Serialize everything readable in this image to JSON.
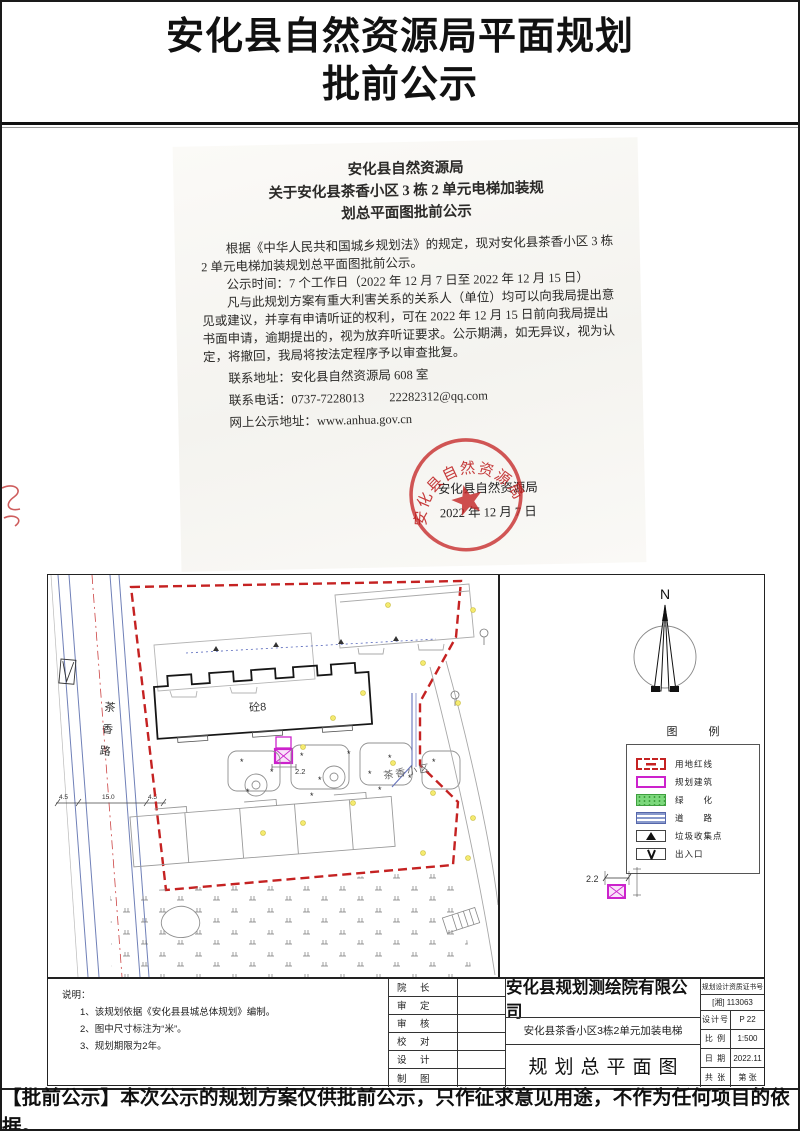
{
  "page": {
    "title_line1": "安化县自然资源局平面规划",
    "title_line2": "批前公示",
    "footer_note": "【批前公示】本次公示的规划方案仅供批前公示，只作征求意见用途，不作为任何项目的依据。"
  },
  "notice": {
    "heading_line1": "安化县自然资源局",
    "heading_line2": "关于安化县茶香小区 3 栋 2 单元电梯加装规",
    "heading_line3": "划总平面图批前公示",
    "para1": "根据《中华人民共和国城乡规划法》的规定，现对安化县茶香小区 3 栋 2 单元电梯加装规划总平面图批前公示。",
    "para2": "公示时间：7 个工作日（2022 年 12 月 7 日至 2022 年 12 月 15 日）",
    "para3": "凡与此规划方案有重大利害关系的关系人（单位）均可以向我局提出意见或建议，并享有申请听证的权利，可在 2022 年 12 月 15 日前向我局提出书面申请，逾期提出的，视为放弃听证要求。公示期满，如无异议，视为认定，将撤回，我局将按法定程序予以审查批复。",
    "contact_address": "联系地址：安化县自然资源局 608 室",
    "contact_phone": "联系电话：0737-7228013　　22282312@qq.com",
    "contact_web": "网上公示地址：www.anhua.gov.cn",
    "signature_org": "安化县自然资源局",
    "signature_date": "2022 年 12 月 7 日",
    "stamp_arc_text": "安化县自然资源局"
  },
  "plan": {
    "road_label": "茶香路",
    "road_dim_left": "4.5",
    "road_dim_mid": "15.0",
    "road_dim_right": "4.5",
    "main_building_label": "砼8",
    "area_label": "茶香小区",
    "elevator_dim": "2.2",
    "detail_dim": "2.2",
    "north_label": "N",
    "legend_title": "图　例",
    "legend_items": [
      "用地红线",
      "规划建筑",
      "绿　　化",
      "道　　路",
      "垃圾收集点",
      "出入口"
    ],
    "notes_title": "说明：",
    "note1": "1、该规划依据《安化县县城总体规划》编制。",
    "note2": "2、图中尺寸标注为“米”。",
    "note3": "3、规划期限为2年。",
    "roles": [
      "院　长",
      "审　定",
      "审　核",
      "校　对",
      "设　计",
      "制　图"
    ],
    "company": "安化县规划测绘院有限公司",
    "project_name": "安化县茶香小区3栋2单元加装电梯",
    "drawing_name": "规划总平面图",
    "cert_label": "规划设计资质证书号",
    "cert_value": "[湘] 113063",
    "row_design_label": "设计号",
    "row_design_value": "P 22",
    "row_scale_label": "比 例",
    "row_scale_value": "1:500",
    "row_date_label": "日 期",
    "row_date_value": "2022.11",
    "row_sheets_label": "共 张",
    "row_sheets_value": "第 张"
  }
}
